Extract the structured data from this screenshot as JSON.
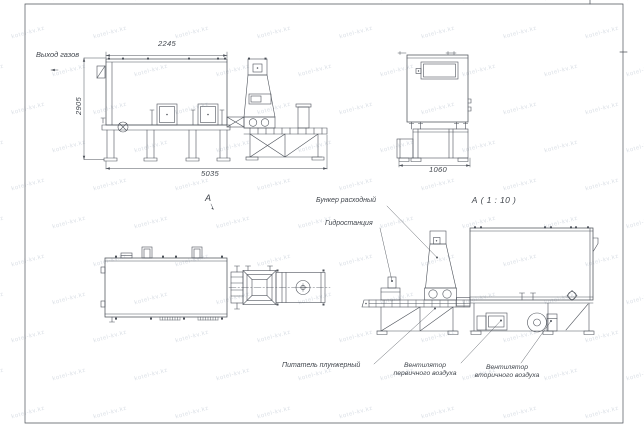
{
  "drawing": {
    "type": "technical-drawing",
    "views": {
      "side": {
        "dim_top": "2245",
        "dim_left": "2905",
        "dim_bottom": "5035",
        "callout_gas_outlet": "Выход газов"
      },
      "front": {
        "dim_bottom": "1060"
      },
      "plan": {
        "view_label": "А"
      },
      "section": {
        "title": "А ( 1 : 10 )",
        "callouts": {
          "hopper": "Бункер расходный",
          "hydraulic": "Гидростанция",
          "feeder": "Питатель плунжерный",
          "primary_fan": "Вентилятор первичного воздуха",
          "secondary_fan": "Вентилятор вторичного воздуха"
        }
      }
    },
    "watermark": {
      "text": "kotel-kv.kz",
      "color": "#b7c0cd"
    },
    "colors": {
      "line": "#4d525a",
      "text": "#41464d"
    }
  }
}
